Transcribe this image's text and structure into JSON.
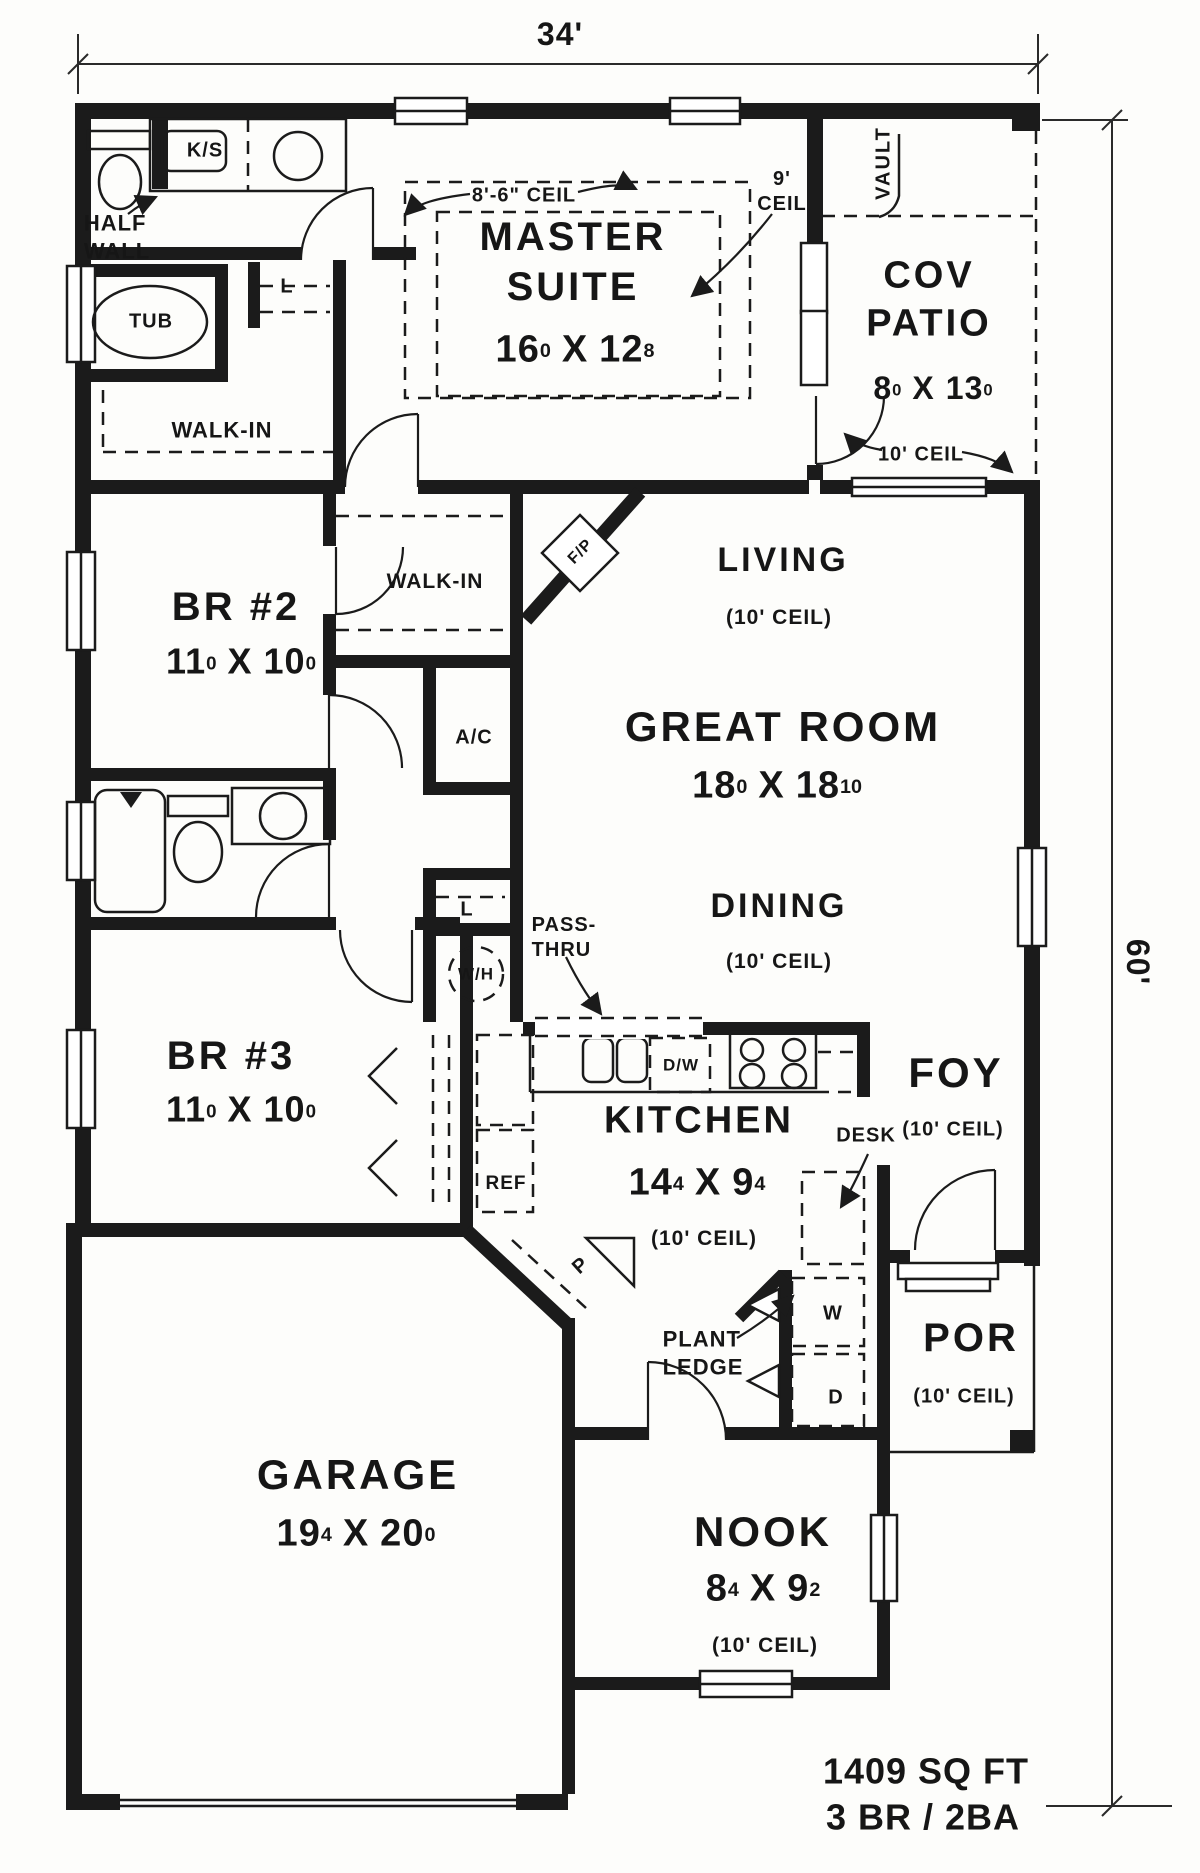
{
  "dimensions": {
    "top": "34'",
    "right": "60'"
  },
  "summary": {
    "area": "1409 SQ FT",
    "config": "3 BR / 2BA"
  },
  "rooms": {
    "master": {
      "name": "MASTER\nSUITE",
      "size": {
        "f1": "16",
        "i1": "0",
        "sep": "X",
        "f2": "12",
        "i2": "8"
      }
    },
    "patio": {
      "name": "COV\nPATIO",
      "size": {
        "f1": "8",
        "i1": "0",
        "sep": "X",
        "f2": "13",
        "i2": "0"
      },
      "ceiling": "10' CEIL",
      "vault": "VAULT"
    },
    "living": {
      "name": "LIVING",
      "ceiling": "(10' CEIL)"
    },
    "great": {
      "name": "GREAT ROOM",
      "size": {
        "f1": "18",
        "i1": "0",
        "sep": "X",
        "f2": "18",
        "i2": "10"
      }
    },
    "dining": {
      "name": "DINING",
      "ceiling": "(10' CEIL)"
    },
    "br2": {
      "name": "BR #2",
      "size": {
        "f1": "11",
        "i1": "0",
        "sep": "X",
        "f2": "10",
        "i2": "0"
      }
    },
    "br3": {
      "name": "BR #3",
      "size": {
        "f1": "11",
        "i1": "0",
        "sep": "X",
        "f2": "10",
        "i2": "0"
      }
    },
    "kitchen": {
      "name": "KITCHEN",
      "size": {
        "f1": "14",
        "i1": "4",
        "sep": "X",
        "f2": "9",
        "i2": "4"
      },
      "ceiling": "(10' CEIL)"
    },
    "foyer": {
      "name": "FOY",
      "ceiling": "(10' CEIL)"
    },
    "porch": {
      "name": "POR",
      "ceiling": "(10' CEIL)"
    },
    "nook": {
      "name": "NOOK",
      "size": {
        "f1": "8",
        "i1": "4",
        "sep": "X",
        "f2": "9",
        "i2": "2"
      },
      "ceiling": "(10' CEIL)"
    },
    "garage": {
      "name": "GARAGE",
      "size": {
        "f1": "19",
        "i1": "4",
        "sep": "X",
        "f2": "20",
        "i2": "0"
      }
    }
  },
  "ceiling_notes": {
    "master_low": "8'-6\" CEIL",
    "master_high": "9'\nCEIL"
  },
  "fixtures": {
    "ks": "K/S",
    "half_wall": "HALF\nWALL",
    "tub": "TUB",
    "master_walkin": "WALK-IN",
    "br2_walkin": "WALK-IN",
    "linen_master": "L",
    "linen_hall": "L",
    "fireplace": "F/P",
    "ac": "A/C",
    "pass_thru": "PASS-\nTHRU",
    "water_heater": "W/H",
    "dishwasher": "D/W",
    "refrigerator": "REF",
    "pantry": "P",
    "desk": "DESK",
    "plant_ledge": "PLANT\nLEDGE",
    "washer": "W",
    "dryer": "D"
  }
}
